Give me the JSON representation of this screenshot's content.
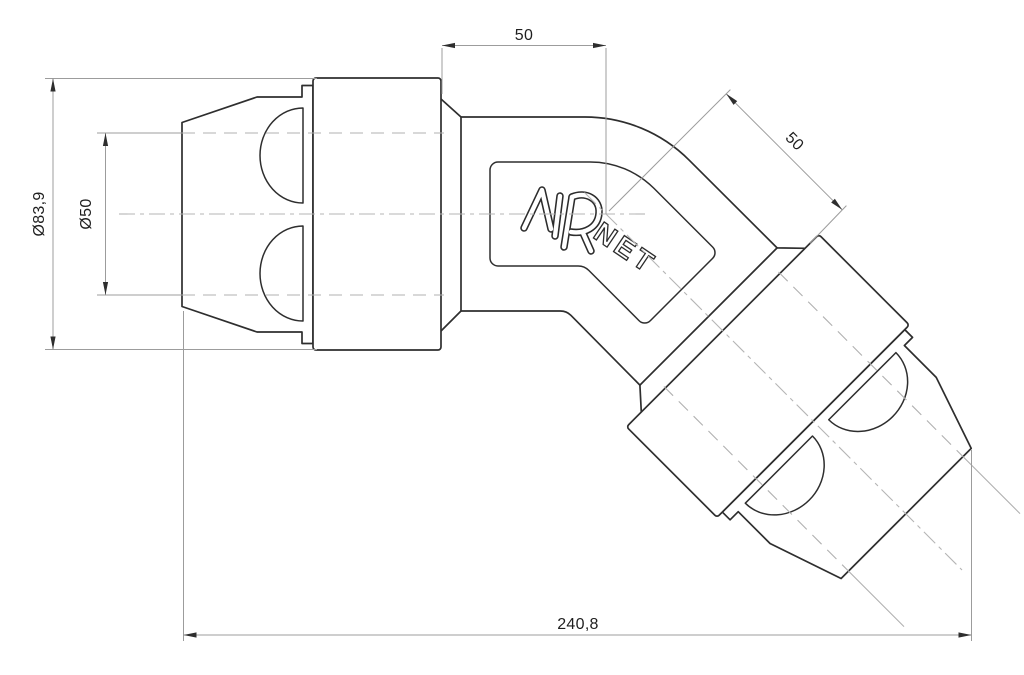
{
  "drawing": {
    "name": "AIRnet 45-degree elbow fitting - dimensioned engineering drawing",
    "logo": {
      "air": "AIR",
      "net": "NET"
    },
    "dimensions": {
      "socket_depth_top": "50",
      "socket_depth_diagonal": "50",
      "outer_diameter": "Ø83,9",
      "pipe_diameter": "Ø50",
      "overall_length": "240,8"
    },
    "colors": {
      "outline": "#2e2e2e",
      "dimension_line": "#9c9c9c",
      "hidden_line": "#b0b0b0",
      "centerline": "#b5b5b5",
      "text": "#1f1f1f",
      "background": "#ffffff"
    }
  }
}
